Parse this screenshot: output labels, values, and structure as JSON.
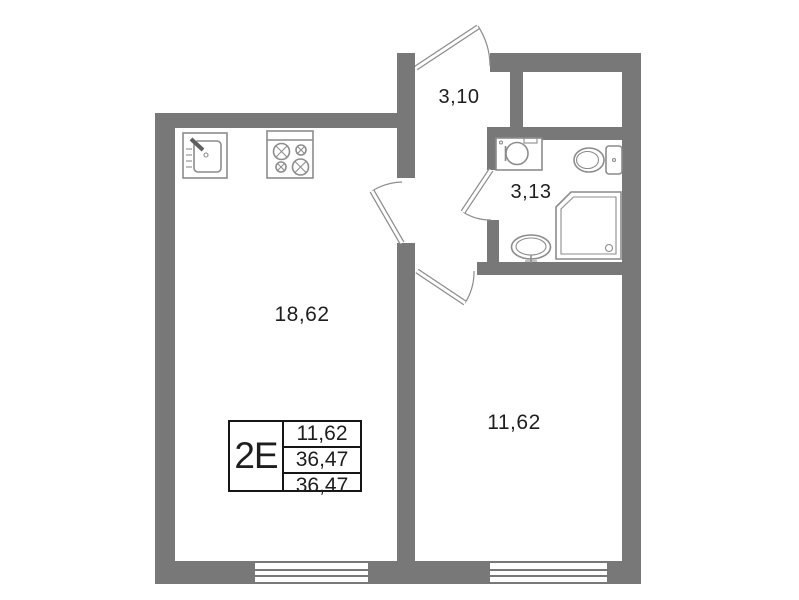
{
  "colors": {
    "wall": "#787878",
    "fixture": "#8c8c8c",
    "text": "#1e1e1e",
    "background": "#ffffff"
  },
  "rooms": [
    {
      "id": "kitchen-living-room",
      "area": "18,62"
    },
    {
      "id": "hallway",
      "area": "3,10"
    },
    {
      "id": "bathroom",
      "area": "3,13"
    },
    {
      "id": "bedroom",
      "area": "11,62"
    }
  ],
  "stamp": {
    "unit_type": "2E",
    "values": [
      "11,62",
      "36,47",
      "36,47"
    ]
  },
  "fixtures": [
    "kitchen-sink-icon",
    "stove-icon",
    "washing-machine-icon",
    "toilet-icon",
    "shower-icon",
    "washbasin-icon"
  ]
}
